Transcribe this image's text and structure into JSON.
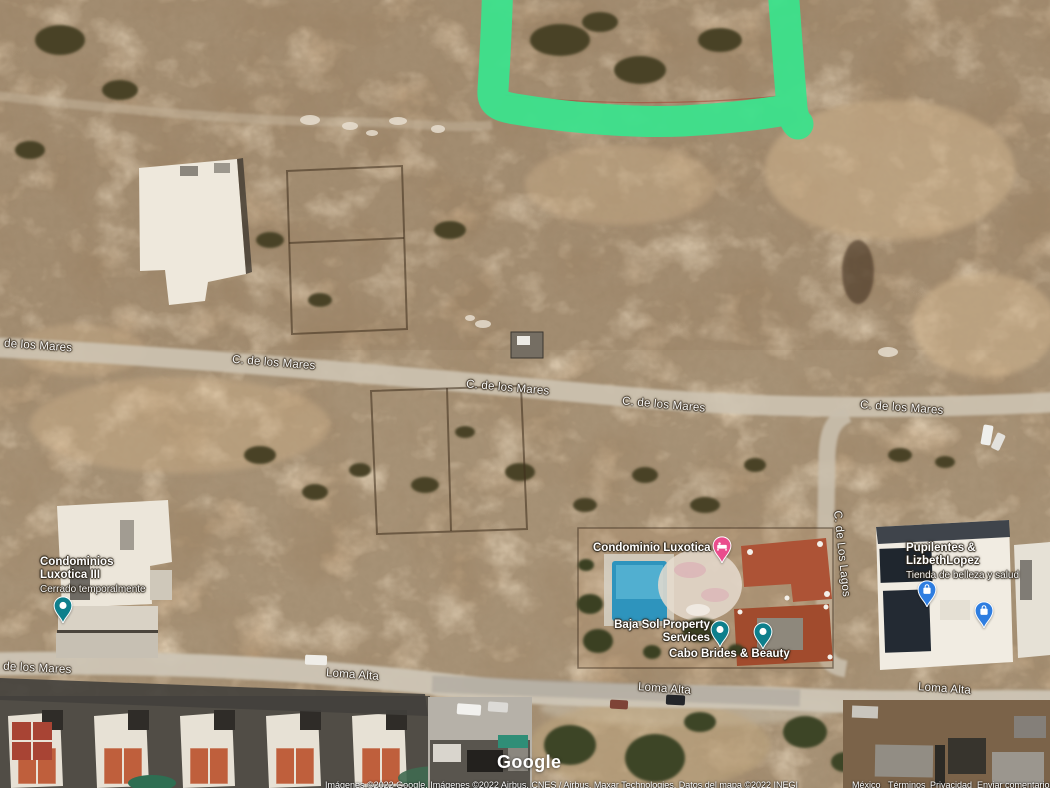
{
  "annotation": {
    "color": "#3ce28c",
    "meaning": "hand-drawn parcel outline"
  },
  "pins": {
    "teal": "#0e7f8c",
    "pink": "#ea4d8d",
    "blue": "#2e7de0"
  },
  "streets": [
    {
      "label": "de los Mares"
    },
    {
      "label": "C. de los Mares"
    },
    {
      "label": "C. de los Mares"
    },
    {
      "label": "C. de los Mares"
    },
    {
      "label": "C. de los Mares"
    },
    {
      "label": "C. de Los Lagos"
    },
    {
      "label": "C. de los Mares"
    },
    {
      "label": "Loma Alta"
    },
    {
      "label": "Loma Alta"
    },
    {
      "label": "Loma Alta"
    }
  ],
  "places": [
    {
      "name": "Condominios Luxotica III",
      "status": "Cerrado temporalmente"
    },
    {
      "name": "Condominio Luxotica II"
    },
    {
      "name": "Baja Sol Property Services"
    },
    {
      "name": "Cabo Brides & Beauty"
    },
    {
      "name": "Pupilentes & LizbethLopez",
      "description": "Tienda de belleza y salud"
    }
  ],
  "footer": {
    "logo": "Google",
    "attribution": "Imágenes ©2022 Google, Imágenes ©2022 Airbus, CNES / Airbus, Maxar Technologies, Datos del mapa ©2022 INEGI",
    "links": [
      "México",
      "Términos",
      "Privacidad",
      "Enviar comentarios"
    ]
  }
}
